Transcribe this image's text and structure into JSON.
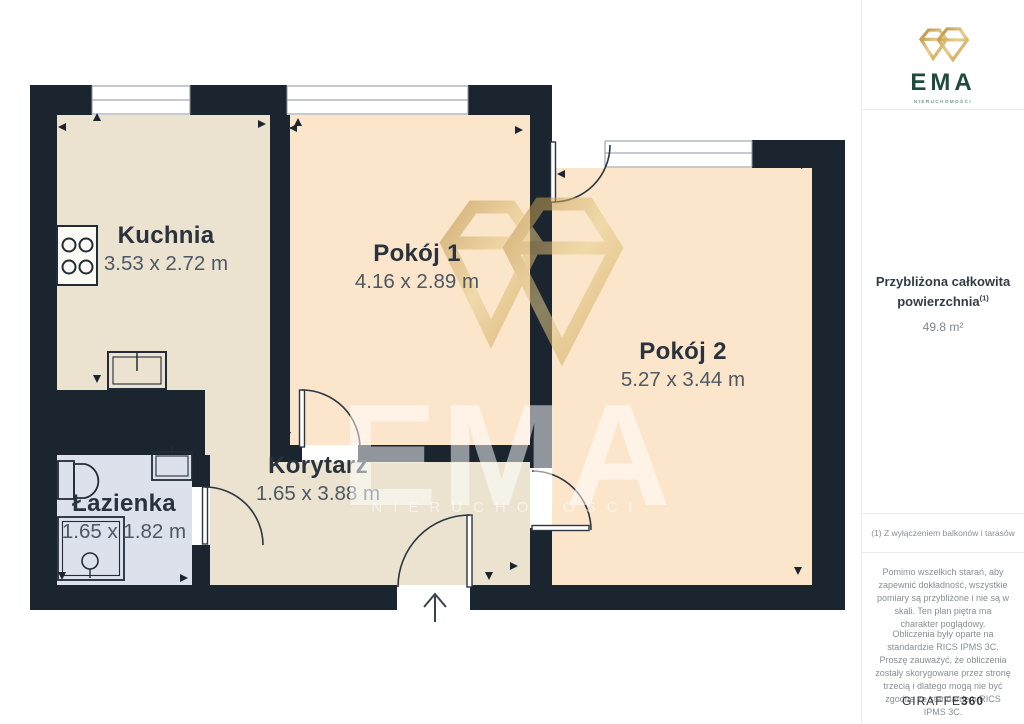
{
  "sidebar": {
    "logo": {
      "brand": "EMA",
      "tagline": "NIERUCHOMOŚCI"
    },
    "area_summary": {
      "title": "Przybliżona całkowita powierzchnia",
      "title_sup": "(1)",
      "value": "49.8 m²"
    },
    "footnote": "(1) Z wyłączeniem balkonów i tarasów",
    "disclaimer1": "Pomimo wszelkich starań, aby zapewnić dokładność, wszystkie pomiary są przybliżone i nie są w skali. Ten plan piętra ma charakter poglądowy.",
    "disclaimer2": "Obliczenia były oparte na standardzie RICS IPMS 3C. Proszę zauważyć, że obliczenia zostały skorygowane przez stronę trzecią i dlatego mogą nie być zgodne ze standardem RICS IPMS 3C.",
    "vendor": {
      "name": "GIRAFFE",
      "suffix": "360"
    }
  },
  "floorplan": {
    "rooms": [
      {
        "id": "kuchnia",
        "name": "Kuchnia",
        "dimensions": "3.53 x 2.72 m"
      },
      {
        "id": "pokoj1",
        "name": "Pokój 1",
        "dimensions": "4.16 x 2.89 m"
      },
      {
        "id": "pokoj2",
        "name": "Pokój 2",
        "dimensions": "5.27 x 3.44 m"
      },
      {
        "id": "korytarz",
        "name": "Korytarz",
        "dimensions": "1.65 x 3.88 m"
      },
      {
        "id": "lazienka",
        "name": "Łazienka",
        "dimensions": "1.65 x 1.82 m"
      }
    ],
    "watermark": {
      "brand": "EMA",
      "tagline": "NIERUCHOMOŚCI"
    }
  },
  "colors": {
    "wall": "#1b2530",
    "floor_cream": "#ebe3cf",
    "floor_peach": "#fce6cb",
    "floor_bath": "#dde1eb",
    "gold_accent": "#d4af5e",
    "brand_green": "#1d4b3f"
  }
}
